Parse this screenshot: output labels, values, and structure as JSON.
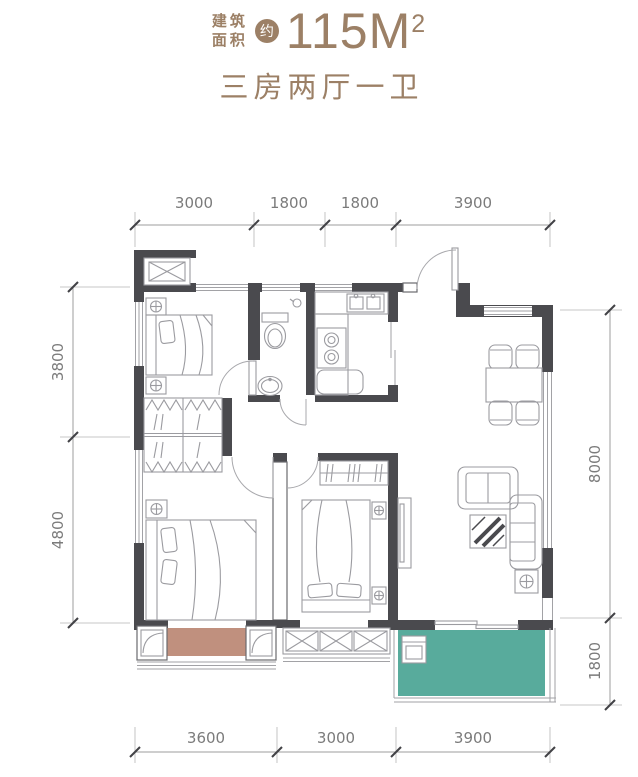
{
  "header": {
    "area_label_line1": "建筑",
    "area_label_line2": "面积",
    "approx_badge": "约",
    "area_value": "115M",
    "area_superscript": "2",
    "subtitle": "三房两厅一卫"
  },
  "dimensions": {
    "top": [
      "3000",
      "1800",
      "1800",
      "3900"
    ],
    "bottom": [
      "3600",
      "3000",
      "3900"
    ],
    "left": [
      "3800",
      "4800"
    ],
    "right": [
      "8000",
      "1800"
    ]
  },
  "colors": {
    "accent": "#9c8066",
    "wall": "#4a4a4e",
    "balcony": "#58ab9c",
    "bay_window": "#c0907e",
    "dim_text": "#7b7b7b",
    "furniture_line": "#9b9ba0"
  }
}
